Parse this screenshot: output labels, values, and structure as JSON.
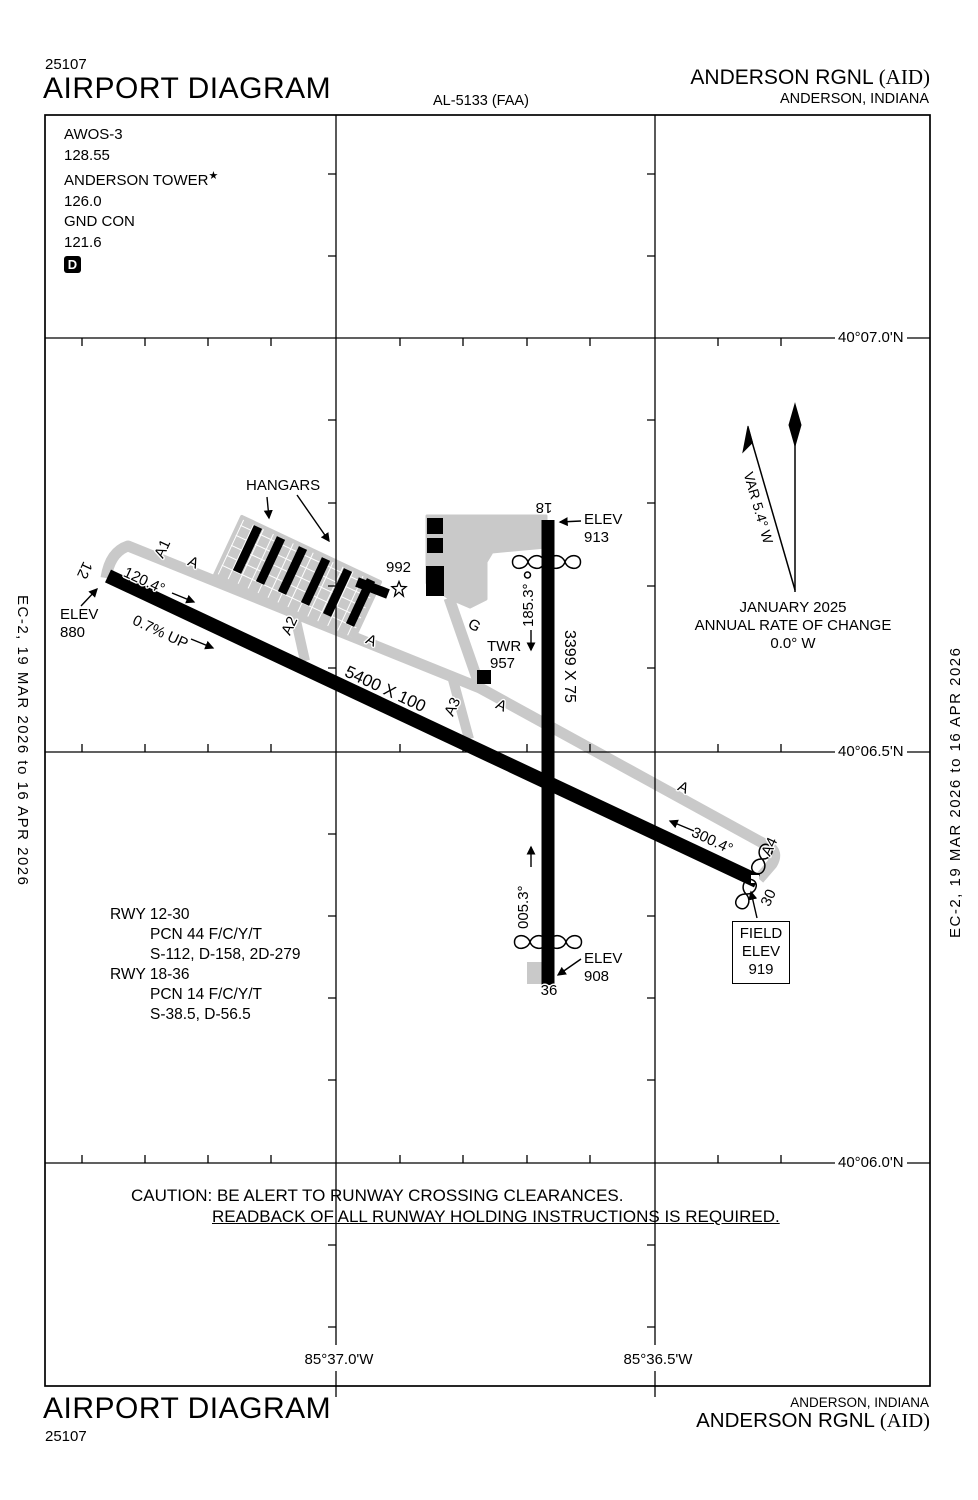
{
  "header": {
    "chart_number": "25107",
    "title": "AIRPORT DIAGRAM",
    "al_number": "AL-5133 (FAA)",
    "airport_name": "ANDERSON RGNL",
    "airport_id": "(AID)",
    "city_state": "ANDERSON, INDIANA"
  },
  "footer": {
    "title": "AIRPORT DIAGRAM",
    "chart_number": "25107",
    "airport_name": "ANDERSON RGNL",
    "airport_id": "(AID)",
    "city_state": "ANDERSON, INDIANA"
  },
  "edge_note": "EC-2,  19 MAR 2026  to  16 APR 2026",
  "frequencies": {
    "awos_label": "AWOS-3",
    "awos_freq": "128.55",
    "tower_label": "ANDERSON TOWER",
    "tower_star": "★",
    "tower_freq": "126.0",
    "ground_label": "GND CON",
    "ground_freq": "121.6",
    "delivery_symbol": "D"
  },
  "compass": {
    "variation": "VAR 5.4° W",
    "date": "JANUARY 2025",
    "rate_label": "ANNUAL RATE OF CHANGE",
    "rate_value": "0.0° W"
  },
  "grid": {
    "latitudes": [
      "40°07.0'N",
      "40°06.5'N",
      "40°06.0'N"
    ],
    "longitudes": [
      "85°37.0'W",
      "85°36.5'W"
    ]
  },
  "runway_12_30": {
    "dimensions": "5400 X 100",
    "number_12": "12",
    "number_30": "30",
    "heading_12": "120.4°",
    "heading_30": "300.4°",
    "gradient": "0.7% UP",
    "elev_12_label": "ELEV",
    "elev_12_value": "880"
  },
  "runway_18_36": {
    "dimensions": "3399 X 75",
    "number_18": "18",
    "number_36": "36",
    "heading_18": "185.3°",
    "heading_36": "005.3°",
    "elev_18_label": "ELEV",
    "elev_18_value": "913",
    "elev_36_label": "ELEV",
    "elev_36_value": "908"
  },
  "field_elevation": {
    "line1": "FIELD",
    "line2": "ELEV",
    "line3": "919"
  },
  "obstruction_992": "992",
  "tower_site": {
    "label": "TWR",
    "elevation": "957"
  },
  "hangars_label": "HANGARS",
  "taxiways": {
    "a": "A",
    "a1": "A1",
    "a2": "A2",
    "a3": "A3",
    "a4": "A4",
    "g": "G"
  },
  "runway_data": {
    "rwy1230_title": "RWY 12-30",
    "rwy1230_pcn": "PCN 44  F/C/Y/T",
    "rwy1230_strength": "S-112, D-158, 2D-279",
    "rwy1836_title": "RWY 18-36",
    "rwy1836_pcn": "PCN 14  F/C/Y/T",
    "rwy1836_strength": "S-38.5, D-56.5"
  },
  "caution": {
    "line1": "CAUTION: BE ALERT TO RUNWAY CROSSING CLEARANCES.",
    "line2": "READBACK OF ALL RUNWAY HOLDING INSTRUCTIONS IS REQUIRED."
  }
}
